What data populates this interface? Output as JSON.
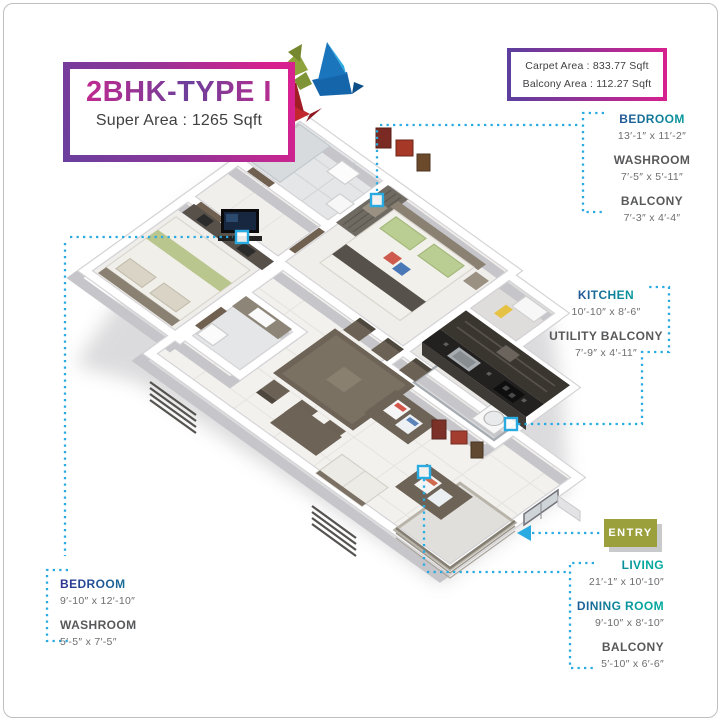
{
  "title_card": {
    "title": "2BHK-TYPE I",
    "subtitle": "Super Area : 1265 Sqft"
  },
  "area_card": {
    "lines": [
      "Carpet Area : 833.77 Sqft",
      "Balcony Area : 112.27 Sqft"
    ]
  },
  "entry": {
    "label": "ENTRY"
  },
  "label_groups": {
    "top_right": {
      "bedroom": {
        "name": "BEDROOM",
        "dims": "13′-1″ x 11′-2″"
      },
      "washroom": {
        "name": "WASHROOM",
        "dims": "7′-5″ x 5′-11″"
      },
      "balcony": {
        "name": "BALCONY",
        "dims": "7′-3″ x 4′-4″"
      }
    },
    "kitchen_side": {
      "kitchen": {
        "name": "KITCHEN",
        "dims": "10′-10″ x 8′-6″"
      },
      "utility_balcony": {
        "name": "UTILITY BALCONY",
        "dims": "7′-9″ x 4′-11″"
      }
    },
    "living_side": {
      "living": {
        "name": "LIVING",
        "dims": "21′-1″ x 10′-10″"
      },
      "dining_room": {
        "name": "DINING ROOM",
        "dims": "9′-10″ x 8′-10″"
      },
      "balcony": {
        "name": "BALCONY",
        "dims": "5′-10″ x 6′-6″"
      }
    },
    "bottom_left": {
      "bedroom": {
        "name": "BEDROOM",
        "dims": "9′-10″ x 12′-10″"
      },
      "washroom": {
        "name": "WASHROOM",
        "dims": "5′-5″ x 7′-5″"
      }
    }
  },
  "colors": {
    "marker_cyan": "#29ABE2",
    "accent_navy": "#2E3192",
    "accent_teal": "#00A79D",
    "magenta": "#D6218E",
    "purple": "#6A3F9E",
    "entry_olive": "#9BA03C",
    "label_gray": "#58595B",
    "dim_gray": "#6D6E71"
  }
}
